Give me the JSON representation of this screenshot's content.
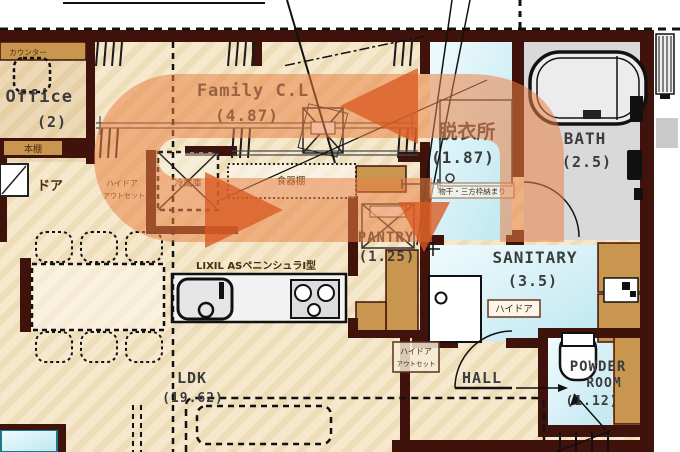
{
  "meta": {
    "type": "floor-plan",
    "overlay": {
      "kind": "circulation-loop-arrow",
      "band_color": "#e8824a",
      "head_color": "#d85c22"
    }
  },
  "colors": {
    "wall": "#40120c",
    "floor": "#f5e8cc",
    "floor_stripe": "#eeddb9",
    "water_blue": "#c9ecf4",
    "bath_gray": "#d9d9d9",
    "cabinet_tan": "#c8964e",
    "arrow_band": "#e8824a",
    "arrow_head": "#d85c22"
  },
  "rooms": {
    "office": {
      "name": "e Office",
      "area": "(2)"
    },
    "family_closet": {
      "name": "Family C.L",
      "area": "(4.87)"
    },
    "dressing_room": {
      "name": "脱衣所",
      "area": "(1.87)"
    },
    "bath": {
      "name": "BATH",
      "area": "(2.5)"
    },
    "sanitary": {
      "name": "SANITARY",
      "area": "(3.5)"
    },
    "pantry": {
      "name": "PANTRY",
      "area": "(1.25)"
    },
    "ldk": {
      "name": "LDK",
      "area": "(19.62)"
    },
    "hall": {
      "name": "HALL"
    },
    "powder_room": {
      "name_line1": "POWDER",
      "name_line2": "ROOM",
      "area": "(1.12)"
    }
  },
  "labels": {
    "counter": "カウンター",
    "bookshelf": "本棚",
    "door": "ドア",
    "high_door_outset": {
      "line1": "ハイドア",
      "line2": "アウトセット"
    },
    "high_door": "ハイドア",
    "frame_note": "物干・三方枠納まり",
    "refrigerator": "冷蔵庫",
    "cupboard": "食器棚",
    "kitchen_model": "LIXIL ASペニンシュラI型"
  }
}
